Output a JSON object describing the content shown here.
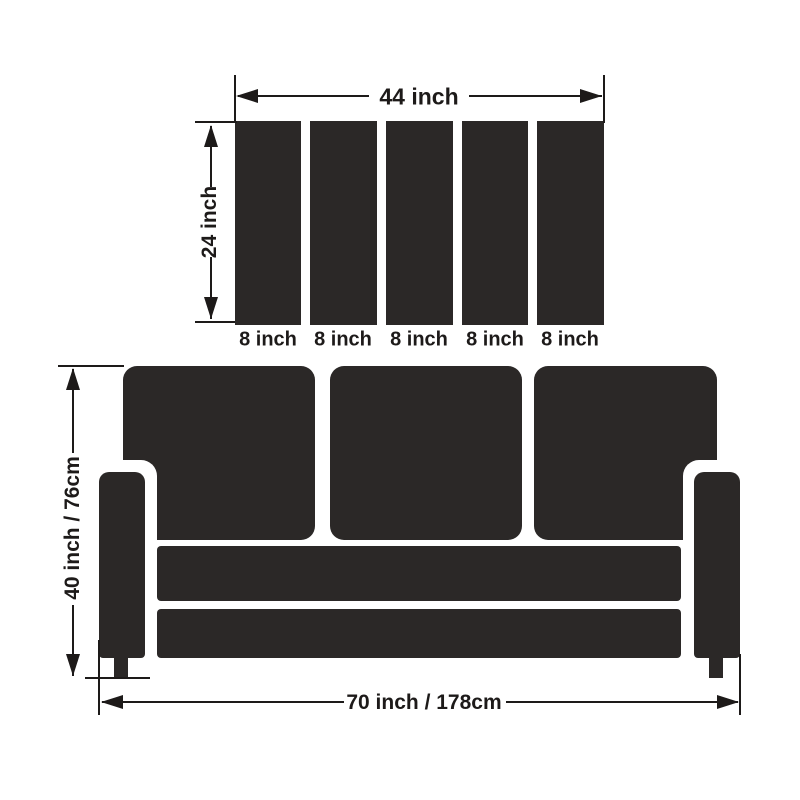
{
  "diagram": {
    "description": "Sofa slipcover dimension diagram",
    "colors": {
      "shape": "#2b2827",
      "line": "#1d1a19",
      "background": "#ffffff"
    },
    "cushion_panel": {
      "total_width_label": "44 inch",
      "height_label": "24 inch",
      "slat_labels": [
        "8 inch",
        "8 inch",
        "8 inch",
        "8 inch",
        "8 inch"
      ]
    },
    "sofa": {
      "height_label": "40 inch / 76cm",
      "width_label": "70 inch / 178cm"
    }
  }
}
